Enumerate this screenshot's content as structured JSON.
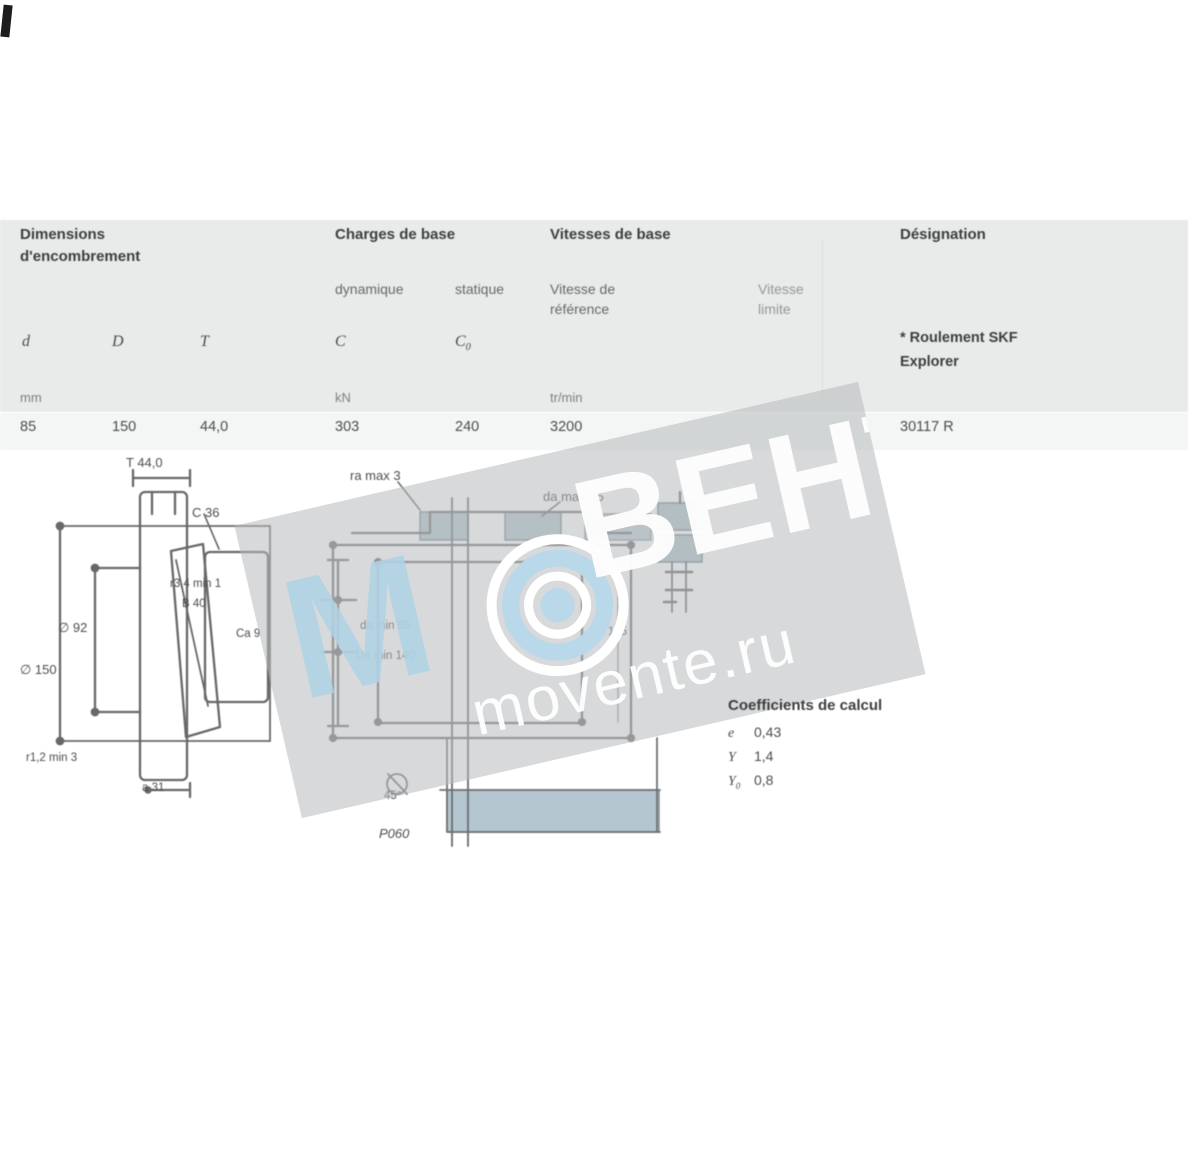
{
  "table": {
    "headers": {
      "dims_line1": "Dimensions",
      "dims_line2": "d'encombrement",
      "loads": "Charges de base",
      "speeds": "Vitesses de base",
      "designation": "Désignation"
    },
    "subheaders": {
      "dynamic": "dynamique",
      "static": "statique",
      "ref_line1": "Vitesse de",
      "ref_line2": "référence",
      "lim_line1": "Vitesse",
      "lim_line2": "limite"
    },
    "symbols": {
      "d": "d",
      "D": "D",
      "T": "T",
      "C": "C",
      "C0_base": "C",
      "C0_sub": "0"
    },
    "note_line1": "* Roulement SKF",
    "note_line2": "Explorer",
    "units": {
      "mm": "mm",
      "kN": "kN",
      "rpm": "tr/min"
    },
    "row": {
      "d": "85",
      "D": "150",
      "T": "44,0",
      "C": "303",
      "C0": "240",
      "ref_speed": "3200",
      "designation": "30117 R"
    }
  },
  "drawings": {
    "left_labels": {
      "t": "T 44,0",
      "c": "C 36",
      "r34": "r3,4 min 1",
      "b": "B 40",
      "d1": "∅ 92",
      "D": "∅ 150",
      "ca": "Ca 9",
      "r12": "r1,2 min 3",
      "a": "a 31"
    },
    "middle_labels": {
      "ra": "ra max 3",
      "da_max": "da max 95",
      "da_min": "da min 95",
      "Da_min": "Da min 140",
      "Db": "Db 145",
      "chamfer": "45°",
      "note": "P060"
    },
    "coefficients": {
      "title": "Coefficients de calcul",
      "e_sym": "e",
      "e_val": "0,43",
      "y_sym": "Y",
      "y_val": "1,4",
      "y0_base": "Y",
      "y0_sub": "0",
      "y0_val": "0,8"
    }
  },
  "watermark": {
    "brand_m": "М",
    "brand_rest": "ВЕНТ",
    "site": "movente.ru"
  },
  "colors": {
    "table_bg": "#e9eaea",
    "shaded_steel": "#a2b9c5",
    "watermark_blue": "#afd2e4",
    "drawing_stroke": "#4c4e50"
  }
}
